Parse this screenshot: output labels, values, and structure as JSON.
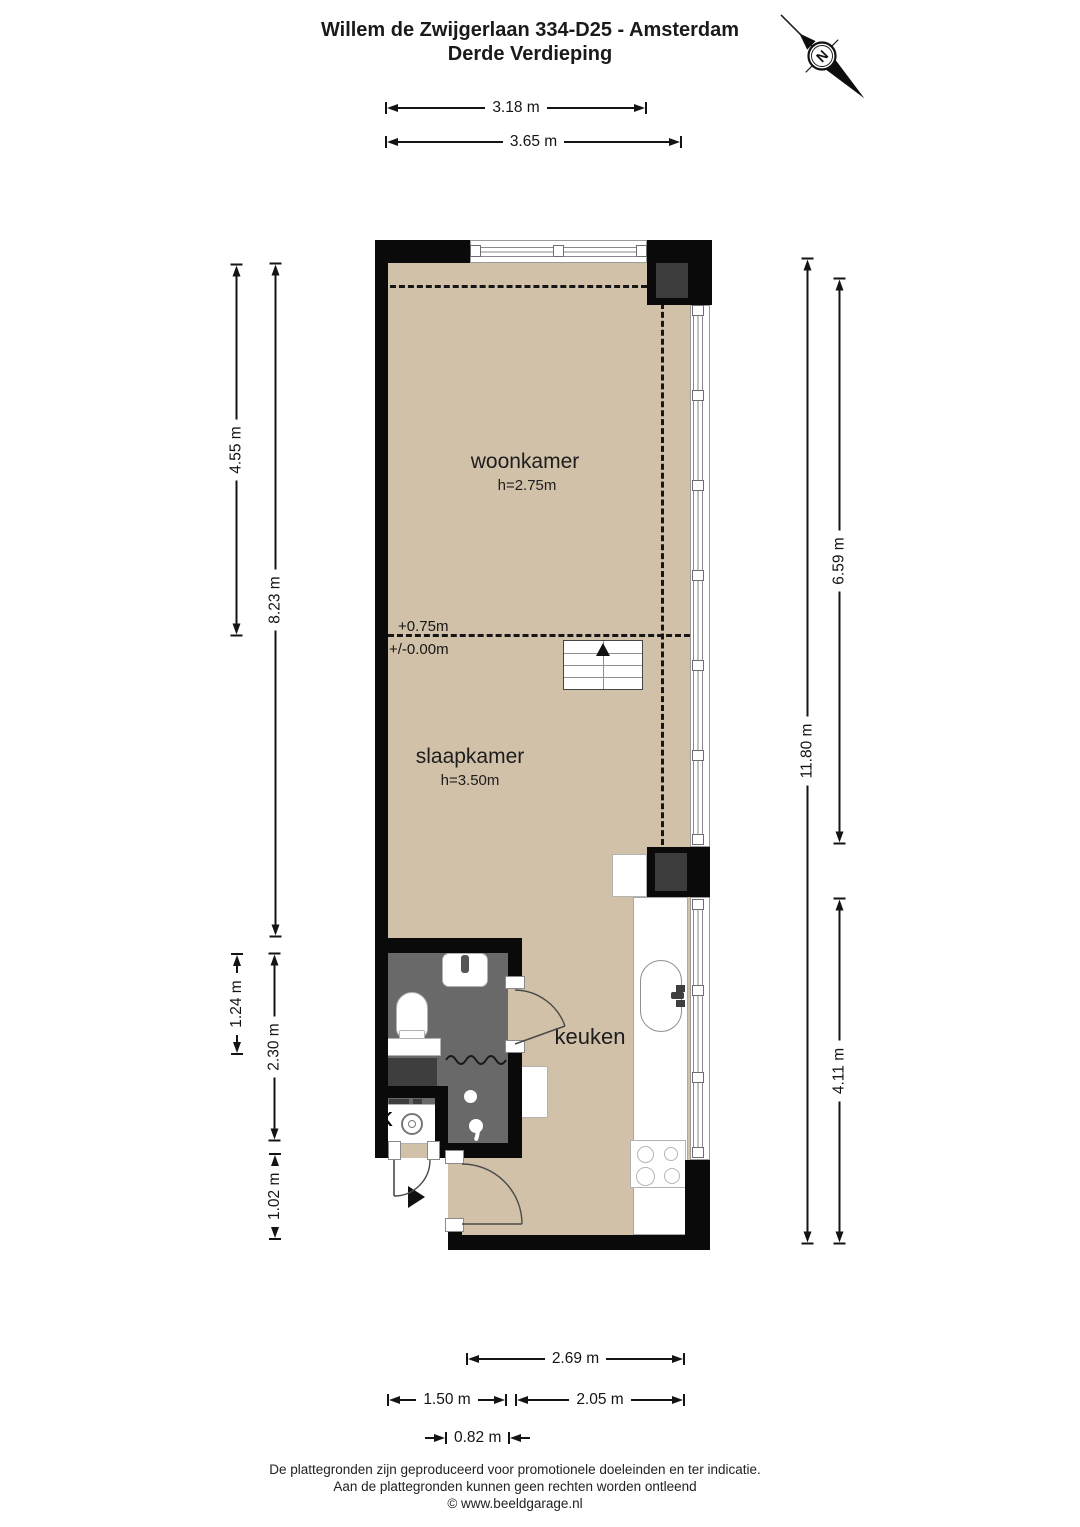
{
  "header": {
    "title_line1": "Willem de Zwijgerlaan 334-D25 - Amsterdam",
    "title_line2": "Derde Verdieping"
  },
  "compass": {
    "north_label": "N"
  },
  "rooms": {
    "woonkamer": {
      "name": "woonkamer",
      "ceiling_height": "h=2.75m"
    },
    "slaapkamer": {
      "name": "slaapkamer",
      "ceiling_height": "h=3.50m"
    },
    "keuken": {
      "name": "keuken"
    },
    "closet": {
      "label": "k"
    }
  },
  "levels": {
    "upper": "+0.75m",
    "lower": "+/-0.00m"
  },
  "dimensions": {
    "top_inner": "3.18 m",
    "top_outer": "3.65 m",
    "left_woonkamer": "4.55 m",
    "left_total_upper": "8.23 m",
    "left_bathroom": "1.24 m",
    "left_bath_block": "2.30 m",
    "left_entrance": "1.02 m",
    "right_upper": "6.59 m",
    "right_total": "11.80 m",
    "right_kitchen": "4.11 m",
    "bottom_kitchen": "2.69 m",
    "bottom_left": "1.50 m",
    "bottom_right": "2.05 m",
    "bottom_door": "0.82 m"
  },
  "footer": {
    "line1": "De plattegronden zijn geproduceerd voor promotionele doeleinden en ter indicatie.",
    "line2": "Aan de plattegronden kunnen geen rechten worden ontleend",
    "line3": "© www.beeldgarage.nl"
  },
  "colors": {
    "wall": "#0a0a0a",
    "floor": "#d0c1a8",
    "bathroom_floor": "#696969",
    "shaft_inset": "#3c3c3c",
    "dimension_line": "#141414",
    "background": "#ffffff"
  }
}
